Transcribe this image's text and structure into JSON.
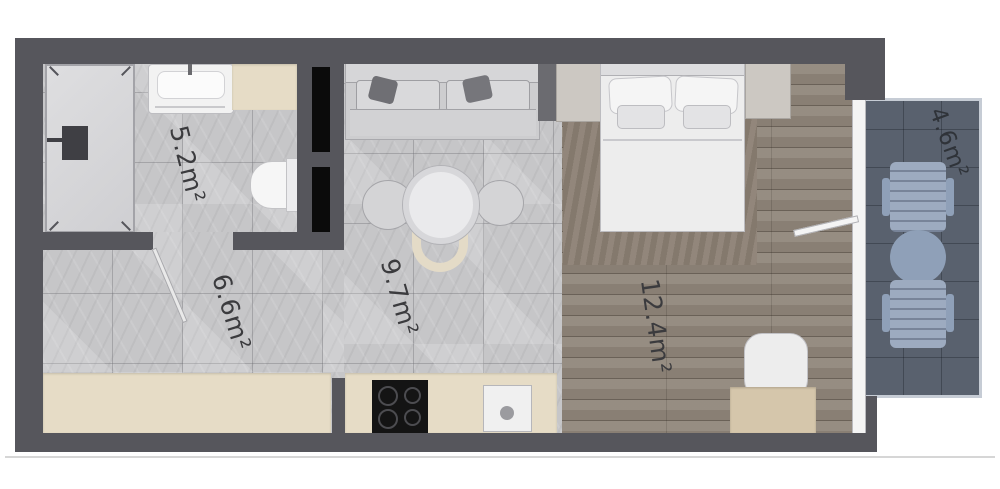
{
  "plan": {
    "type": "apartment-floor-plan-top-view",
    "rooms": [
      {
        "id": "bathroom",
        "area_label": "5.2m²"
      },
      {
        "id": "hallway",
        "area_label": "6.6m²"
      },
      {
        "id": "kitchen-living",
        "area_label": "9.7m²"
      },
      {
        "id": "bedroom",
        "area_label": "12.4m²"
      },
      {
        "id": "balcony",
        "area_label": "4.6m²"
      }
    ],
    "colors": {
      "wall": "#56565c",
      "wall_inset": "#0b0b0b",
      "marble_floor": "#c6c6c8",
      "wood_floor": "#90867a",
      "balcony_floor": "#59616e",
      "cabinet_beige": "#e6dcc6",
      "fixture_white": "#f2f2f2",
      "balcony_furniture": "#9dabc0",
      "label_text": "#3b3b3e"
    }
  }
}
